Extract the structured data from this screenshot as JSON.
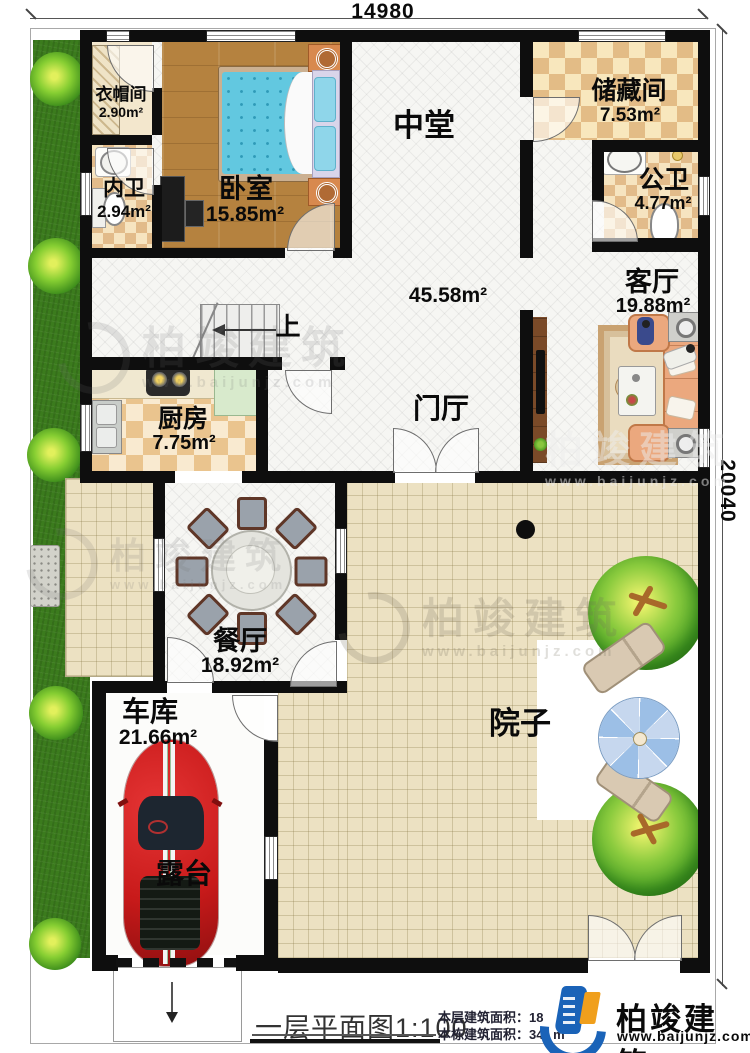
{
  "dimensions": {
    "width_mm": "14980",
    "depth_mm": "20040"
  },
  "rooms": {
    "cloakroom": {
      "name": "衣帽间",
      "area": "2.90m²"
    },
    "inner_bath": {
      "name": "内卫",
      "area": "2.94m²"
    },
    "bedroom": {
      "name": "卧室",
      "area": "15.85m²"
    },
    "hall": {
      "name": "中堂",
      "area": "45.58m²"
    },
    "storage": {
      "name": "储藏间",
      "area": "7.53m²"
    },
    "public_bath": {
      "name": "公卫",
      "area": "4.77m²"
    },
    "living": {
      "name": "客厅",
      "area": "19.88m²"
    },
    "kitchen": {
      "name": "厨房",
      "area": "7.75m²"
    },
    "foyer": {
      "name": "门厅"
    },
    "dining": {
      "name": "餐厅",
      "area": "18.92m²"
    },
    "garage": {
      "name": "车库",
      "area": "21.66m²"
    },
    "courtyard": {
      "name": "院子"
    },
    "terrace": {
      "name": "露台"
    }
  },
  "stairs": {
    "direction_label": "上"
  },
  "title_block": {
    "plan_title": "一层平面图1:100",
    "floor_area_label": "本层建筑面积：",
    "floor_area_value": "18",
    "total_area_label": "本栋建筑面积：",
    "total_area_value": "34",
    "total_area_unit": "m"
  },
  "branding": {
    "company": "柏竣建筑",
    "website": "www.baijunjz.com"
  },
  "watermark": {
    "company": "柏竣建筑",
    "website": "www.baijunjz.com"
  },
  "colors": {
    "wall": "#0e0e0e",
    "accent_blue": "#1a63b8",
    "accent_orange": "#f09f1c",
    "grass": "#3b7b1d",
    "paving": "#ece1c2",
    "checker": "#e3bc86",
    "wood_floor": "#b5823f",
    "bed_blue": "#62c8e0",
    "car_red": "#c81a1a"
  }
}
